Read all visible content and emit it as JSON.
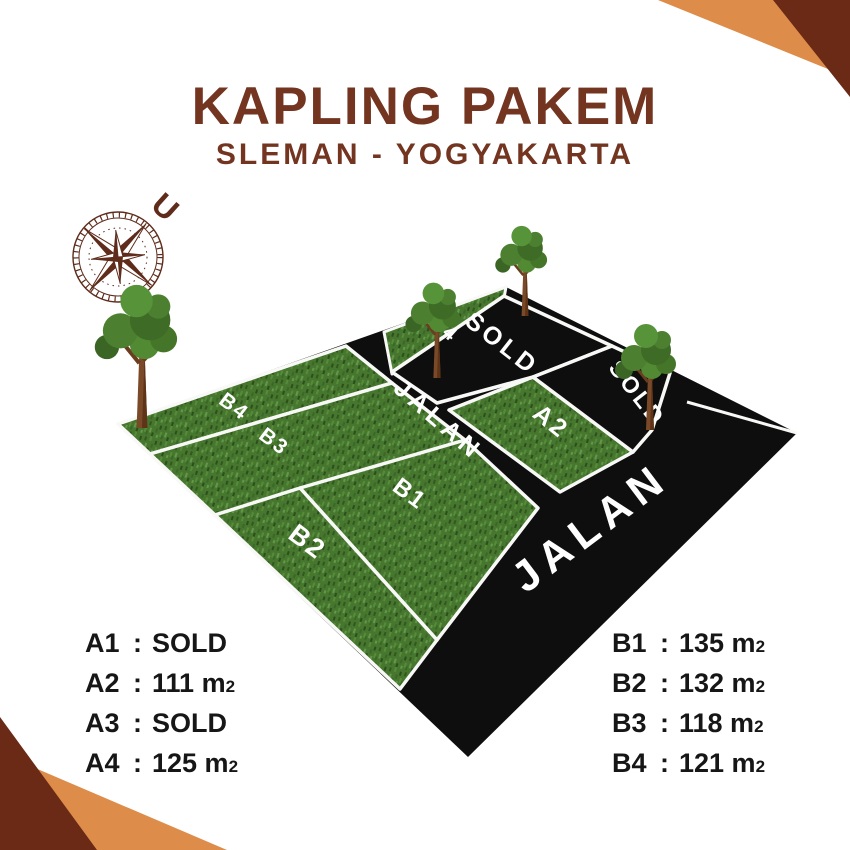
{
  "title": "KAPLING PAKEM",
  "subtitle": "SLEMAN - YOGYAKARTA",
  "compass": {
    "north_label": "U"
  },
  "map": {
    "roads": [
      {
        "id": "inner",
        "label": "JALAN"
      },
      {
        "id": "outer",
        "label": "JALAN"
      }
    ],
    "plots": [
      {
        "id": "A4",
        "label": "A4",
        "status": "available"
      },
      {
        "id": "A3",
        "label": "SOLD",
        "status": "sold"
      },
      {
        "id": "A2",
        "label": "A2",
        "status": "available"
      },
      {
        "id": "A1",
        "label": "SOLD",
        "status": "sold"
      },
      {
        "id": "B1",
        "label": "B1",
        "status": "available"
      },
      {
        "id": "B2",
        "label": "B2",
        "status": "available"
      },
      {
        "id": "B3",
        "label": "B3",
        "status": "available"
      },
      {
        "id": "B4",
        "label": "B4",
        "status": "available"
      }
    ]
  },
  "legend": {
    "sep": ":",
    "left": [
      {
        "code": "A1",
        "value": "SOLD",
        "sup": ""
      },
      {
        "code": "A2",
        "value": "111 m",
        "sup": "2"
      },
      {
        "code": "A3",
        "value": "SOLD",
        "sup": ""
      },
      {
        "code": "A4",
        "value": "125 m",
        "sup": "2"
      }
    ],
    "right": [
      {
        "code": "B1",
        "value": "135 m",
        "sup": "2"
      },
      {
        "code": "B2",
        "value": "132 m",
        "sup": "2"
      },
      {
        "code": "B3",
        "value": "118 m",
        "sup": "2"
      },
      {
        "code": "B4",
        "value": "121 m",
        "sup": "2"
      }
    ]
  },
  "colors": {
    "brand_brown": "#733420",
    "accent_orange": "#dd8c49",
    "dark_brown": "#6b2a15",
    "grass_green": "#47762f",
    "road_black": "#0e0e0e",
    "line_white": "#f8f8f6"
  }
}
